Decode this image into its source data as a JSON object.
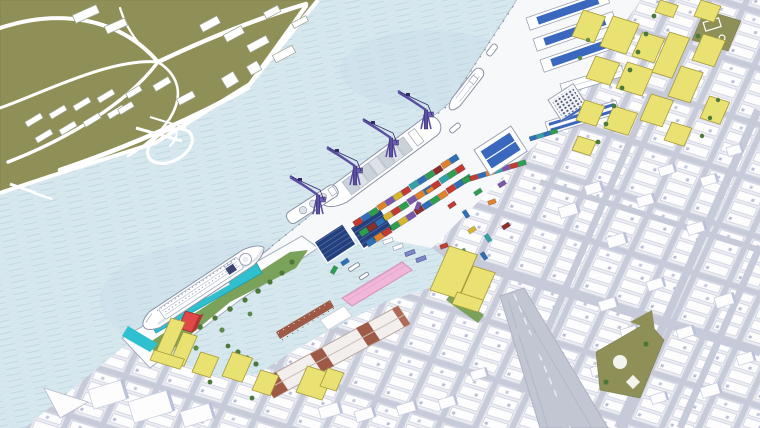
{
  "scene": {
    "kind": "axonometric-waterfront-masterplan-illustration",
    "regions": [
      {
        "name": "open-water"
      },
      {
        "name": "governors-island-park"
      },
      {
        "name": "container-terminal"
      },
      {
        "name": "atlantic-basin"
      },
      {
        "name": "cruise-pier"
      },
      {
        "name": "waterfront-warehouse-strip"
      },
      {
        "name": "city-grid"
      },
      {
        "name": "yellow-development-blocks"
      },
      {
        "name": "ballfields-park"
      },
      {
        "name": "highway"
      }
    ],
    "counts": {
      "gantry_cranes": 4,
      "container_rows": 3,
      "blue_roof_sheds": 4,
      "ships": 5
    }
  },
  "colors": {
    "water": "#d6e7ee",
    "water_hatch": "#bdd8e2",
    "water_patch": "#c9dfe9",
    "island_land": "#8f9058",
    "path_white": "#ffffff",
    "land_white": "#f7f8fa",
    "coast_stroke": "#a3adbc",
    "street": "#c7cad8",
    "block_fill": "#ecedf3",
    "block_stroke": "#d5d8e3",
    "bldg_white": "#fdfdfe",
    "bldg_stroke": "#c6cbdc",
    "bldg_shadow": "#bcc1da",
    "window_dark": "#454e70",
    "shed_blue": "#3a68bf",
    "yellow_face": "#e9e172",
    "yellow_side": "#cfc353",
    "yellow_top": "#f4f09e",
    "yellow_outline": "#a79a39",
    "teal": "#2fc0cf",
    "teal_dark": "#1a9aa8",
    "park_green": "#7ba25a",
    "tree_green": "#4d783c",
    "olive": "#8f9058",
    "pink": "#f1b7d9",
    "pink_stroke": "#d590bd",
    "red_bldg": "#e04747",
    "red_side": "#b23434",
    "brick": "#9e5a47",
    "crane": "#5a4fa2",
    "crane_dark": "#322c66",
    "solar": "#24407c",
    "solar_line": "#47659e",
    "highway": "#c2c5d2",
    "lane": "#e8eaf0",
    "hull_stroke": "#8a93a6",
    "stack_gray": "#ccd2da",
    "cont_red": "#c23b32",
    "cont_blue": "#2f6fb5",
    "cont_green": "#2f9e4f",
    "cont_orange": "#e0812c",
    "cont_purple": "#7b57a8",
    "cont_yellow": "#d7b52e",
    "cont_teal": "#2fa3a8",
    "cont_dkred": "#8e2f28"
  }
}
